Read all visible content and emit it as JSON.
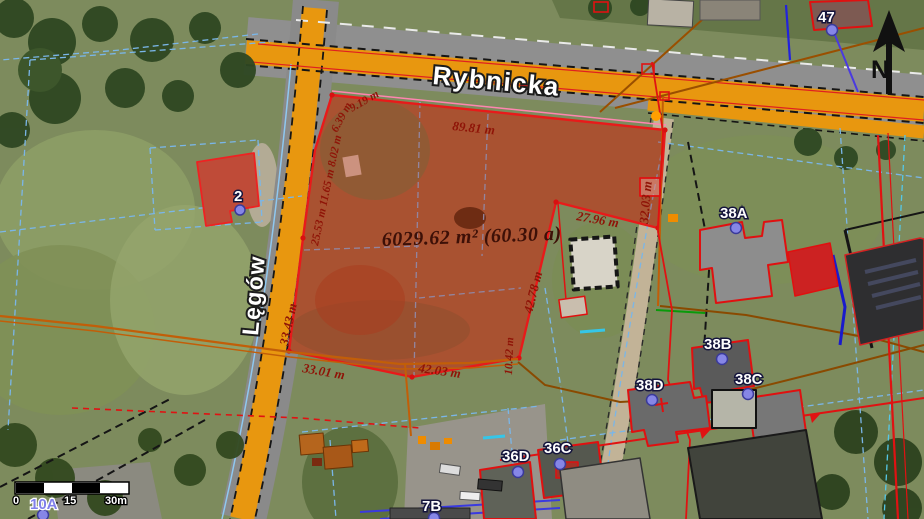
{
  "map": {
    "streets": {
      "rybnicka": "Rybnicka",
      "legow": "Lęgów"
    },
    "parcel": {
      "area_label": "6029.62 m² (60.30 a)",
      "measurements": {
        "top": "89.81 m",
        "right_vertical": "32.03 m",
        "right_horizontal": "27.96 m",
        "right_lower_vertical": "42.78 m",
        "right_short_vertical": "10.42 m",
        "bottom_right": "42.03 m",
        "bottom_left": "33.01 m",
        "left_lower_vertical": "33.43 m",
        "left_chain": "25.53 m 11.65 m 8.02 m",
        "left_corner": "6.39 m",
        "left_top": "9.19 m"
      }
    },
    "addresses": {
      "h47": "47",
      "h38a": "38A",
      "h38b": "38B",
      "h38c": "38C",
      "h38d": "38D",
      "h36c": "36C",
      "h36d": "36D",
      "h7b": "7B",
      "h10a": "10A",
      "h2": "2"
    },
    "scale_bar": {
      "start": "0",
      "mid": "15",
      "end": "30m"
    },
    "north_label": "N",
    "colors": {
      "road_orange": "#E8970F",
      "parcel_overlay": "rgba(198,32,12,0.33)",
      "boundary_red": "#E81A1A",
      "cadastral_blue": "#7AB6E8",
      "measurement_text": "#8F1407",
      "utility_orange": "#C25E08",
      "address_dot": "#8686E6"
    }
  }
}
